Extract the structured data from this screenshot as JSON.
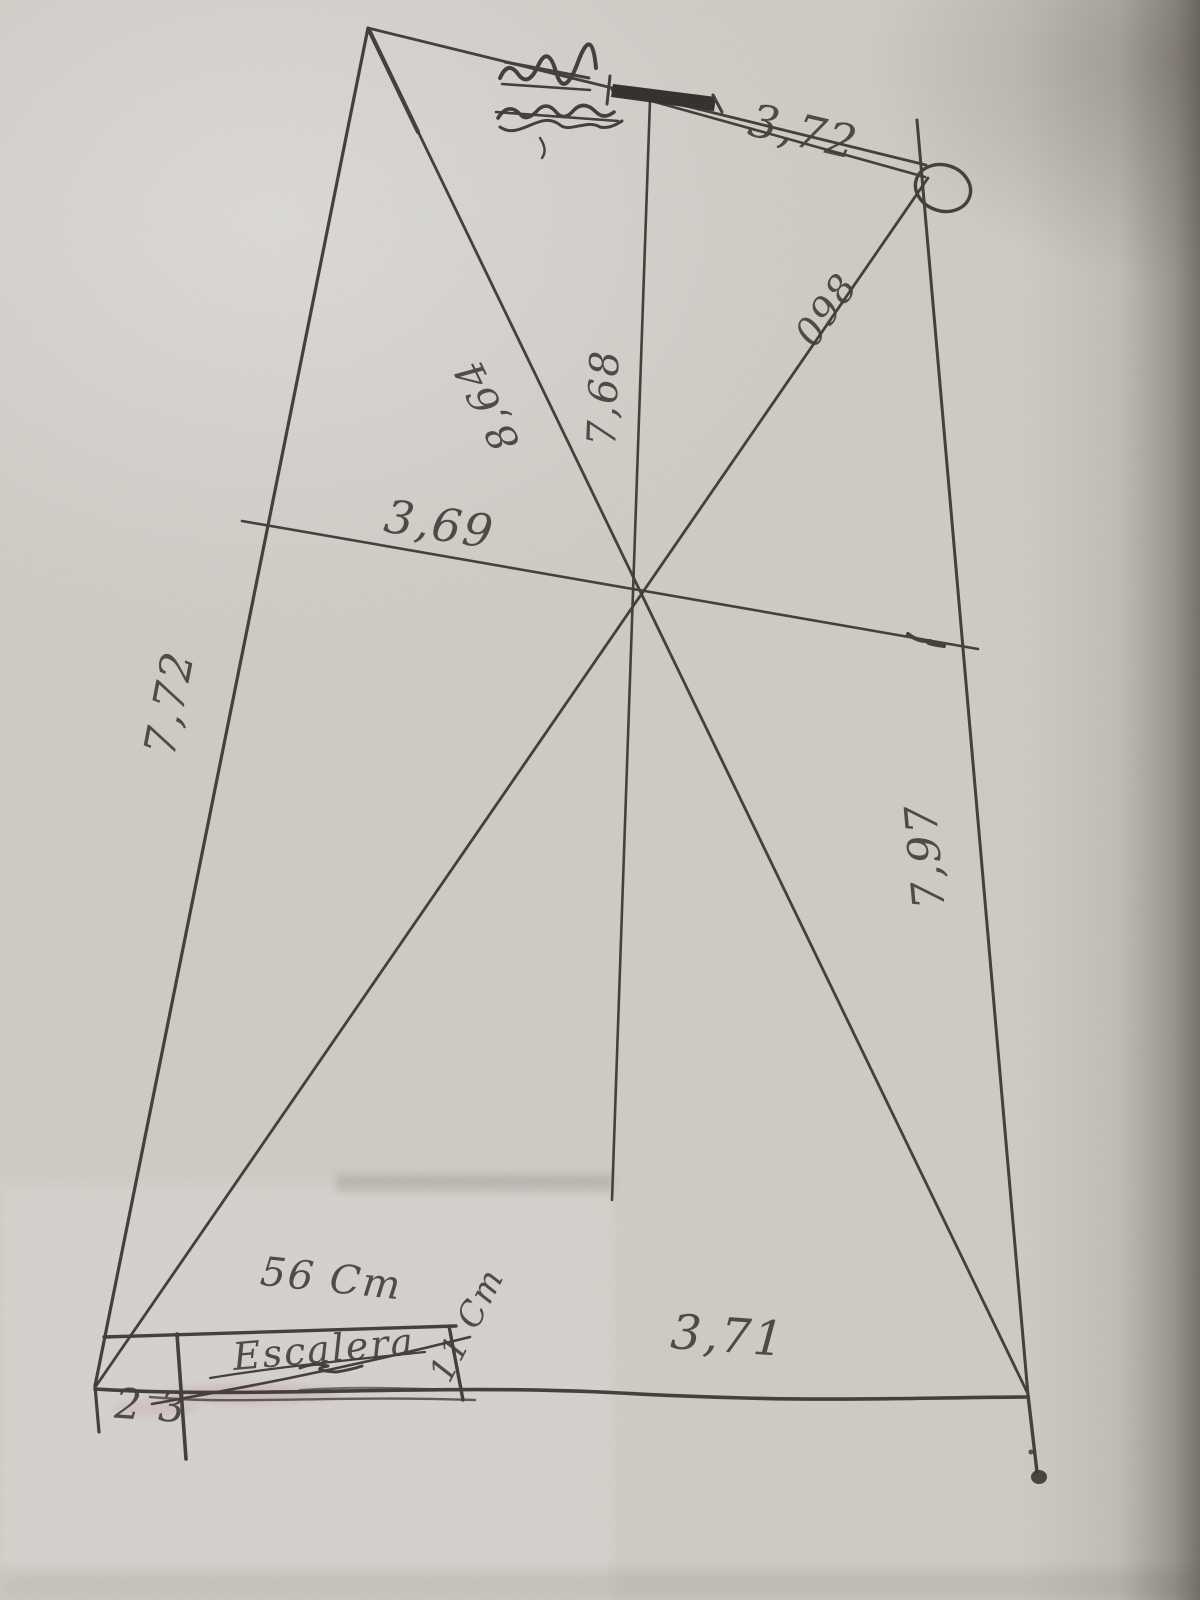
{
  "colors": {
    "paper": "#d2cfc9",
    "ink": "#3e3b36",
    "inkdark": "#2e2c28"
  },
  "sketch": {
    "labels": {
      "top_width": "3,72",
      "upper_right_segment": "098",
      "diagonal": "8,64",
      "vertical": "7,68",
      "mid_width": "3,69",
      "left_side": "7,72",
      "right_side": "7,97",
      "bottom_width": "3,71",
      "stair_width": "56 Cm",
      "stair_name": "Escalera",
      "stair_depth": "11 Cm",
      "corner_note": "2 3"
    }
  }
}
